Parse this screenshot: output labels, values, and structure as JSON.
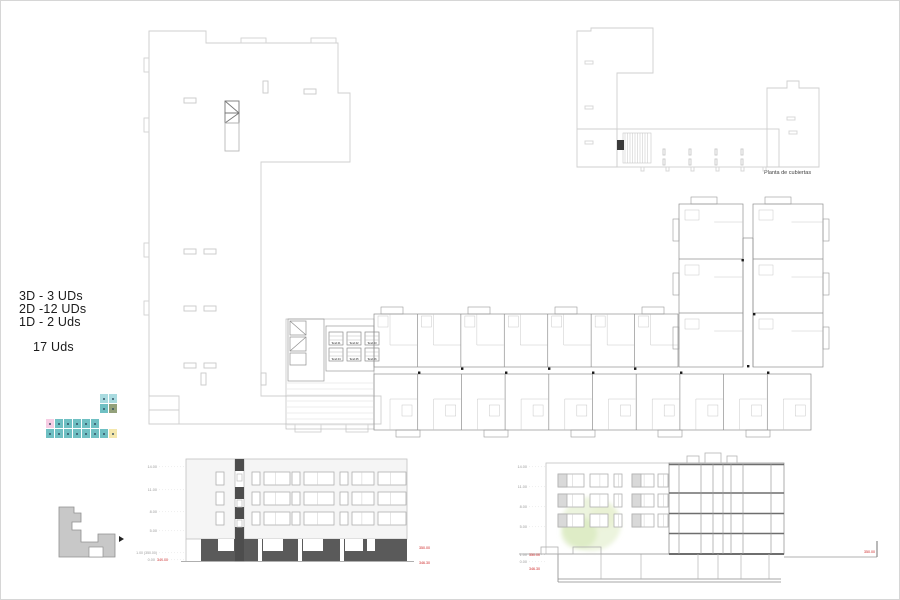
{
  "legend": {
    "line1": "3D - 3 UDs",
    "line2": "2D -12 UDs",
    "line3": "1D - 2 Uds",
    "total": "17 Uds"
  },
  "roof_plan": {
    "caption": "Planta de cubiertas"
  },
  "floor_plan": {
    "tend_labels": [
      "Tend.01",
      "Tend.02",
      "Tend.03",
      "Tend.04",
      "Tend.05",
      "Tend.06"
    ]
  },
  "key_plan": {
    "palette": {
      "teal": "#6fc0c3",
      "cyan": "#a9dbe0",
      "pink": "#f7cde4",
      "olive": "#93a17b",
      "yellow": "#f4e7ac",
      "dot": "#2e4a5e"
    },
    "column_rows": [
      [
        "cyan",
        "cyan"
      ],
      [
        "teal",
        "olive"
      ]
    ],
    "row1": [
      "pink",
      "teal",
      "teal",
      "teal",
      "teal",
      "teal"
    ],
    "row2": [
      "teal",
      "teal",
      "teal",
      "teal",
      "teal",
      "teal",
      "teal",
      "yellow"
    ]
  },
  "elevation": {
    "levels": [
      "14.00",
      "11.00",
      "8.00",
      "5.00"
    ],
    "base_level": "1.00 (350.00)",
    "zero_level": "0.00",
    "zero_value_red": "349.00",
    "red_right_top": "350.00",
    "red_right_bottom": "346.30"
  },
  "section": {
    "levels": [
      "14.00",
      "11.00",
      "8.00",
      "5.00",
      "1.00",
      "0.00"
    ],
    "red_left_top": "350.00",
    "red_left_bottom": "346.30",
    "red_right": "350.00"
  },
  "colors": {
    "red": "#cc2222",
    "dark_band": "#5a5a5a",
    "plan_light": "#cfcfcf",
    "plan_mid": "#8f8f8f",
    "hint": "#c6c6c6"
  }
}
